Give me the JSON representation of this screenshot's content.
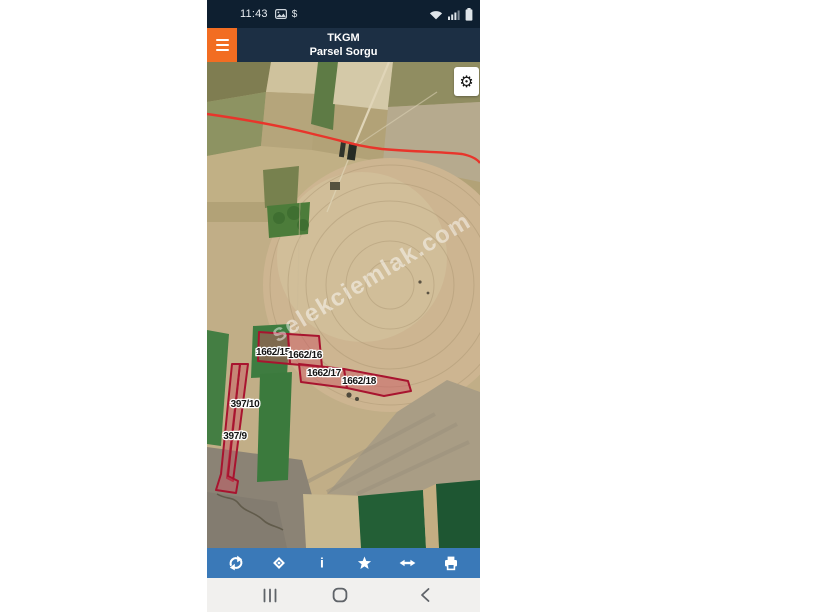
{
  "status_bar": {
    "time": "11:43",
    "dollar_glyph": "$",
    "left_icons": [
      "screenshot-icon",
      "dollar-icon"
    ],
    "right_icons": [
      "wifi-icon",
      "signal-icon",
      "battery-icon"
    ]
  },
  "header": {
    "app_title": "TKGM",
    "subtitle": "Parsel Sorgu"
  },
  "map": {
    "settings_glyph": "⚙",
    "watermark": "selekciemlak.com",
    "parcels": [
      {
        "label": "1662/15"
      },
      {
        "label": "1662/16"
      },
      {
        "label": "1662/17"
      },
      {
        "label": "1662/18"
      },
      {
        "label": "397/10"
      },
      {
        "label": "397/9"
      }
    ]
  },
  "toolbar": {
    "info_glyph": "i",
    "buttons": [
      "refresh",
      "locate",
      "info",
      "favorite",
      "measure",
      "print"
    ]
  },
  "nav_bar": {
    "buttons": [
      "recents",
      "home",
      "back"
    ]
  },
  "colors": {
    "accent_orange": "#f26d22",
    "status_navy": "#0e1f30",
    "header_navy": "#1c2f44",
    "toolbar_blue": "#3a79b8",
    "parcel_stroke": "#a8142f",
    "parcel_fill": "rgba(205,85,97,0.45)",
    "road_red": "#e8352b"
  }
}
